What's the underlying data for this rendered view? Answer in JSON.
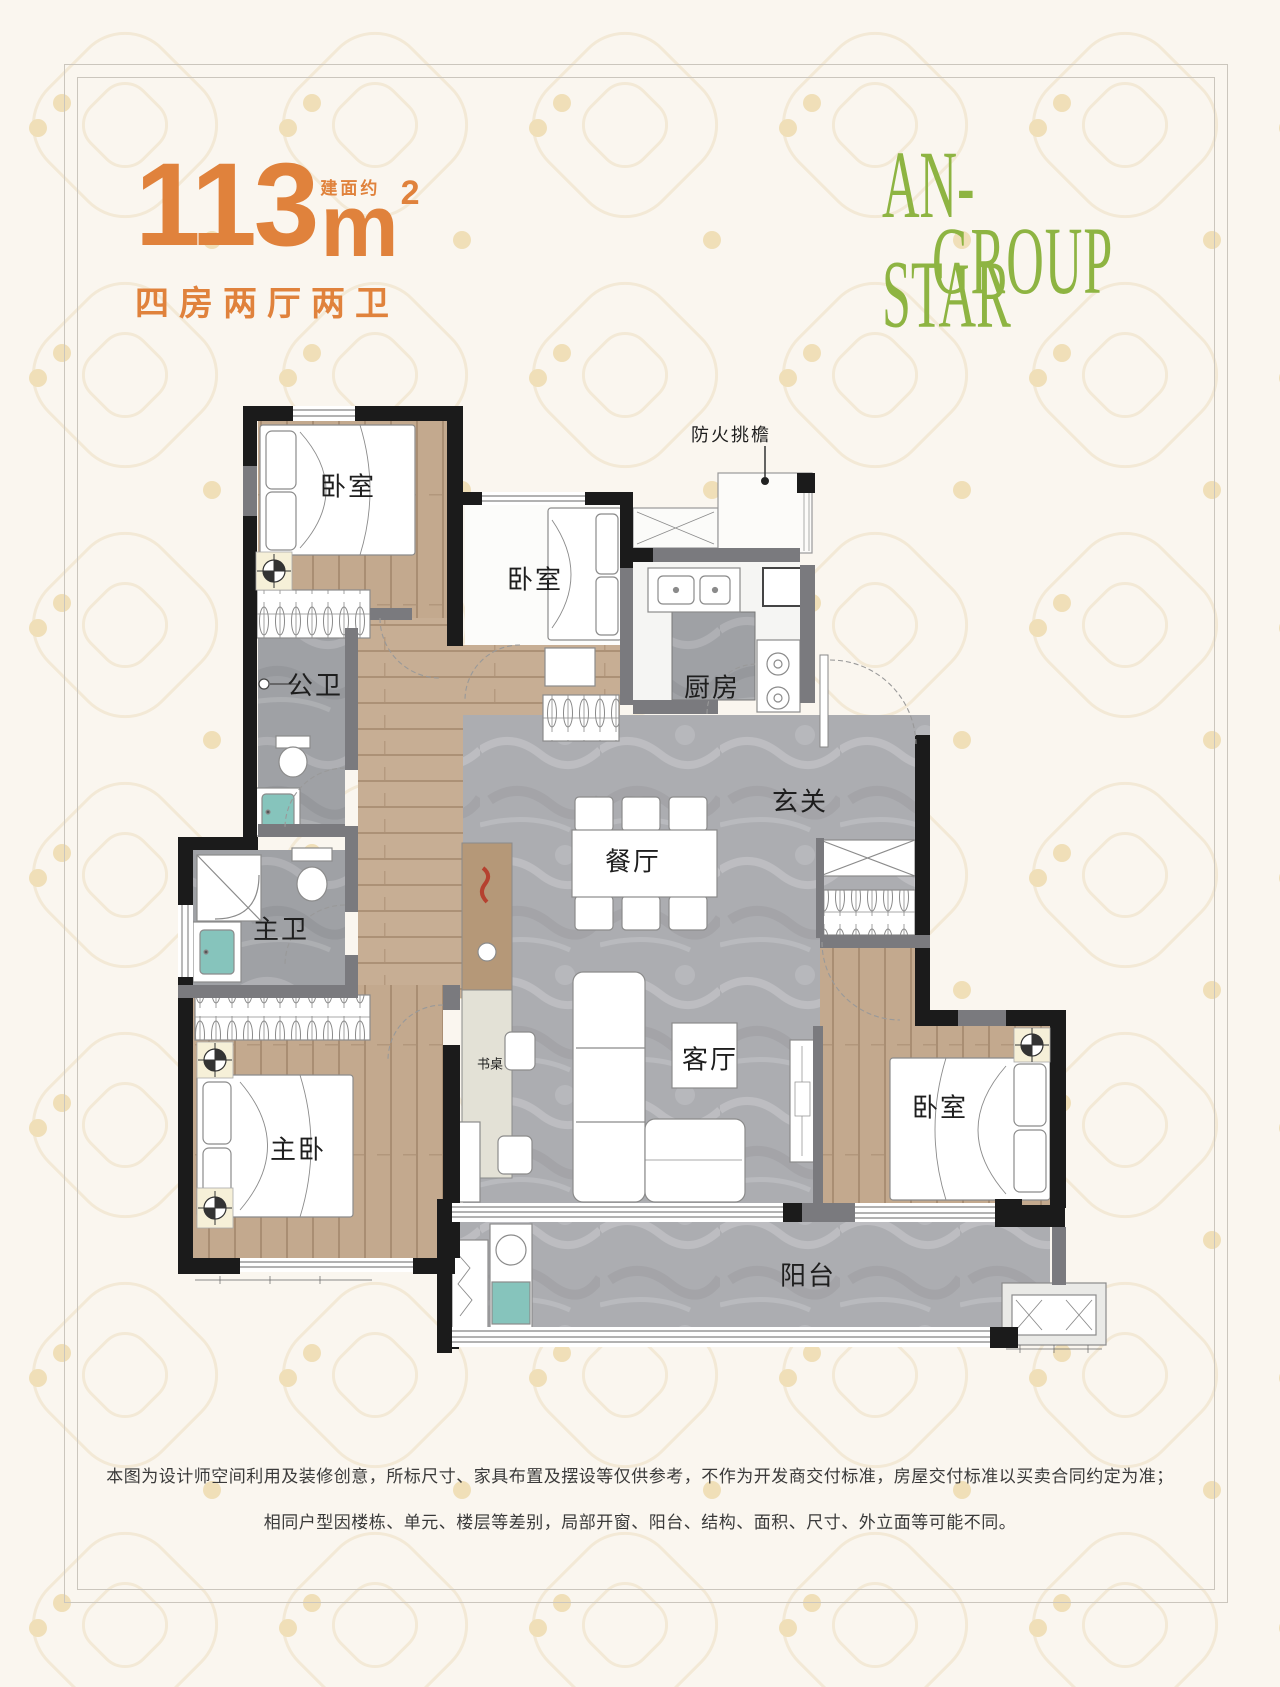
{
  "header": {
    "area_value": "113",
    "area_prefix": "建面约",
    "area_unit": "m",
    "area_exponent": "2",
    "subtitle": "四房两厅两卫"
  },
  "logo": {
    "line1": "AN-STAR",
    "line2": "GROUP"
  },
  "floorplan": {
    "annotation": "防火挑檐",
    "rooms": [
      {
        "id": "bedroom-top-left",
        "label": "卧室"
      },
      {
        "id": "bedroom-top-middle",
        "label": "卧室"
      },
      {
        "id": "kitchen",
        "label": "厨房"
      },
      {
        "id": "bath-public",
        "label": "公卫"
      },
      {
        "id": "bath-master",
        "label": "主卫"
      },
      {
        "id": "foyer",
        "label": "玄关"
      },
      {
        "id": "dining-room",
        "label": "餐厅"
      },
      {
        "id": "living-room",
        "label": "客厅"
      },
      {
        "id": "master-bedroom",
        "label": "主卧"
      },
      {
        "id": "bedroom-right",
        "label": "卧室"
      },
      {
        "id": "balcony",
        "label": "阳台"
      },
      {
        "id": "desk",
        "label": "书桌"
      }
    ]
  },
  "footer": {
    "line1": "本图为设计师空间利用及装修创意，所标尺寸、家具布置及摆设等仅供参考，不作为开发商交付标准，房屋交付标准以买卖合同约定为准；",
    "line2": "相同户型因楼栋、单元、楼层等差别，局部开窗、阳台、结构、面积、尺寸、外立面等可能不同。"
  },
  "colors": {
    "accent_orange": "#E0823C",
    "logo_green": "#8EB442",
    "background": "#FAF6EF",
    "wall_black": "#1B1B1B",
    "wall_gray": "#7A7A7E",
    "marble_gray": "#ACADB1",
    "wood_tan": "#C3A98E",
    "basin_teal": "#86C4BC"
  }
}
